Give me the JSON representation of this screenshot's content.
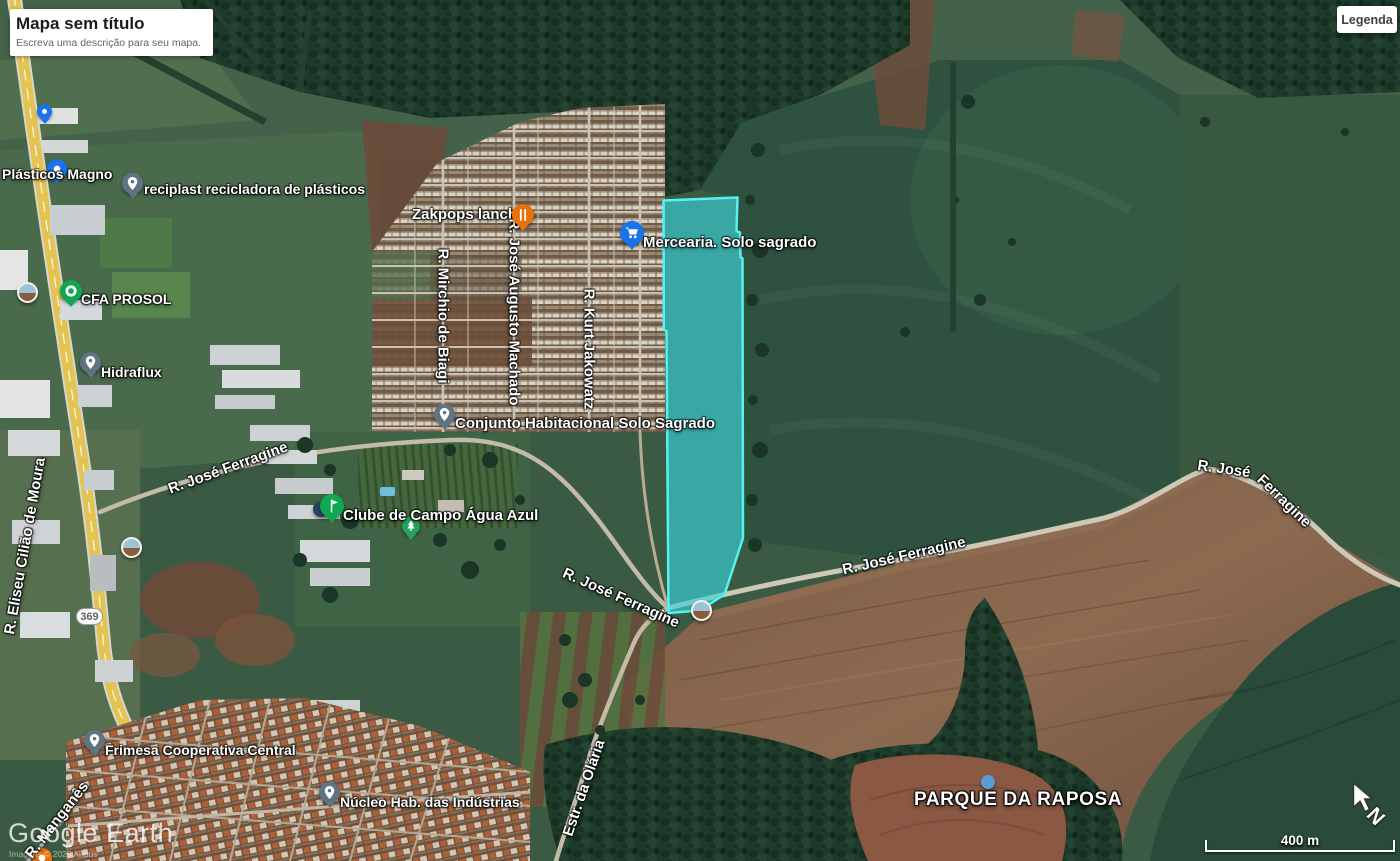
{
  "title_card": {
    "title": "Mapa sem título",
    "subtitle": "Escreva uma descrição para seu mapa."
  },
  "legend_button": {
    "label": "Legenda"
  },
  "hud": {
    "watermark": "Google Earth",
    "attribution": "Imagens © 2025 Airbus",
    "scale_label": "400 m",
    "north_label": "N",
    "route_badge": "369"
  },
  "colors": {
    "selection_fill": "#3ad1d6",
    "selection_stroke": "#55f2f2",
    "poi_blue": "#1a73e8",
    "poi_green": "#0ea853",
    "poi_orange": "#e8710a",
    "placemark_gray": "#5f7480",
    "highway_yellow": "#e3c351"
  },
  "icons": {
    "placemark": "pin-drop",
    "shopping": "cart",
    "restaurant": "fork-knife",
    "sports_club": "golf-flag",
    "park_tree": "tree",
    "photo": "photo-sphere",
    "poi_dot": "dot",
    "north": "n-arrow",
    "cursor": "mouse-arrow"
  },
  "poi_labels": [
    {
      "text": "Plásticos Magno"
    },
    {
      "text": "reciplast recicladora de plásticos"
    },
    {
      "text": "CFA PROSOL"
    },
    {
      "text": "Hidraflux"
    },
    {
      "text": "Zakpops lanches"
    },
    {
      "text": "Mercearia. Solo sagrado"
    },
    {
      "text": "Conjunto Habitacional Solo Sagrado"
    },
    {
      "text": "Clube de Campo Água Azul"
    },
    {
      "text": "Frimesa Cooperativa Central"
    },
    {
      "text": "Núcleo Hab. das Indústrias"
    },
    {
      "text": "PARQUE DA RAPOSA"
    }
  ],
  "road_labels": [
    {
      "text": "R. Mirchio de Biagi"
    },
    {
      "text": "R. José Augusto Machado"
    },
    {
      "text": "R. Kurt Jakowatz"
    },
    {
      "text": "R. José Ferragine"
    },
    {
      "text": "R. Eliseu Cilião de Moura"
    },
    {
      "text": "R. José Ferragine"
    },
    {
      "text": "R. José Ferragine"
    },
    {
      "text": "R. José"
    },
    {
      "text": "Ferragine"
    },
    {
      "text": "Estr. da Olária"
    },
    {
      "text": "R. Manganês"
    }
  ]
}
